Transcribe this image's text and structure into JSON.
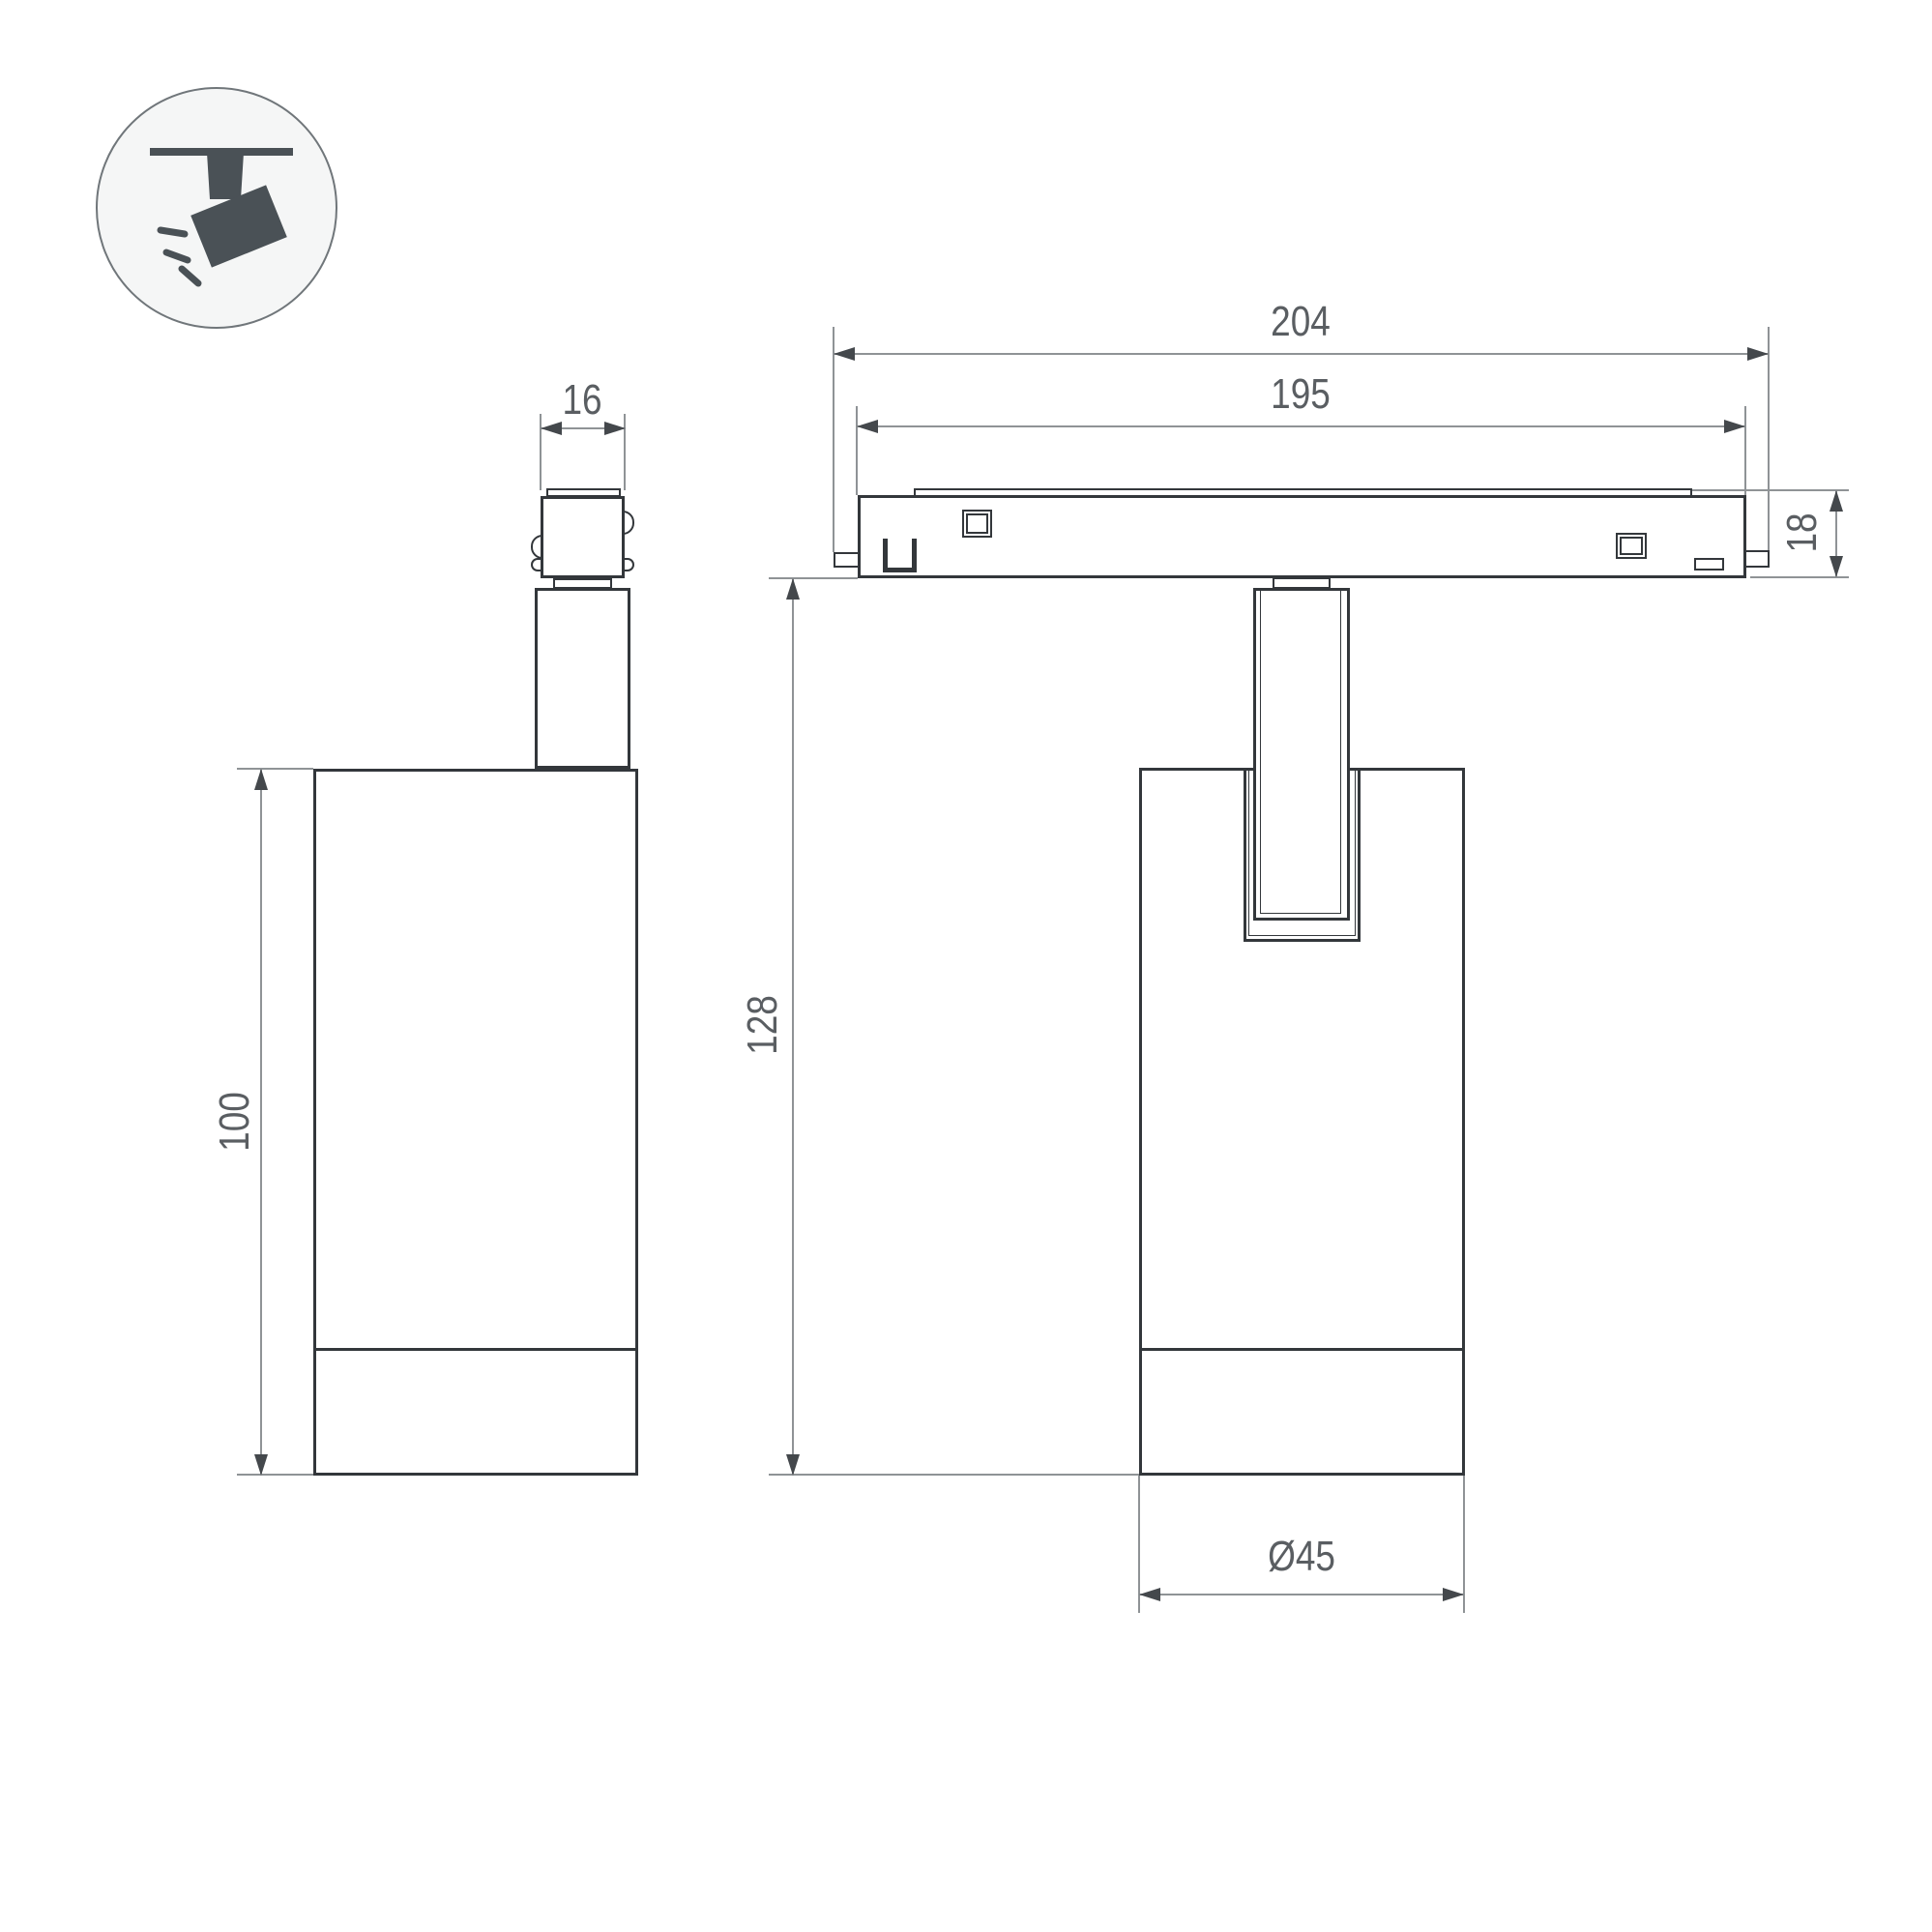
{
  "drawing": {
    "type": "technical-dimension-drawing",
    "product": "magnetic track spotlight",
    "views": [
      "side",
      "front"
    ]
  },
  "legend_icon": {
    "name": "ceiling-track-spotlight-icon",
    "description": "dark spotlight silhouette hanging from ceiling track with light rays, inside a circle"
  },
  "views": {
    "side_view": {
      "dim_adapter_width": "16",
      "dim_body_height": "100"
    },
    "front_view": {
      "dim_overall_width": "204",
      "dim_track_length": "195",
      "dim_track_height": "18",
      "dim_overall_height": "128",
      "dim_body_diameter": "Ø45"
    }
  },
  "colors": {
    "outline": "#33373b",
    "dimension_line": "#8f9396",
    "arrowhead": "#44484c",
    "text": "#5a5e62",
    "icon_fill": "#4a5156",
    "icon_circle_fill": "#f5f6f6",
    "icon_circle_stroke": "#70767a",
    "background": "#ffffff"
  }
}
